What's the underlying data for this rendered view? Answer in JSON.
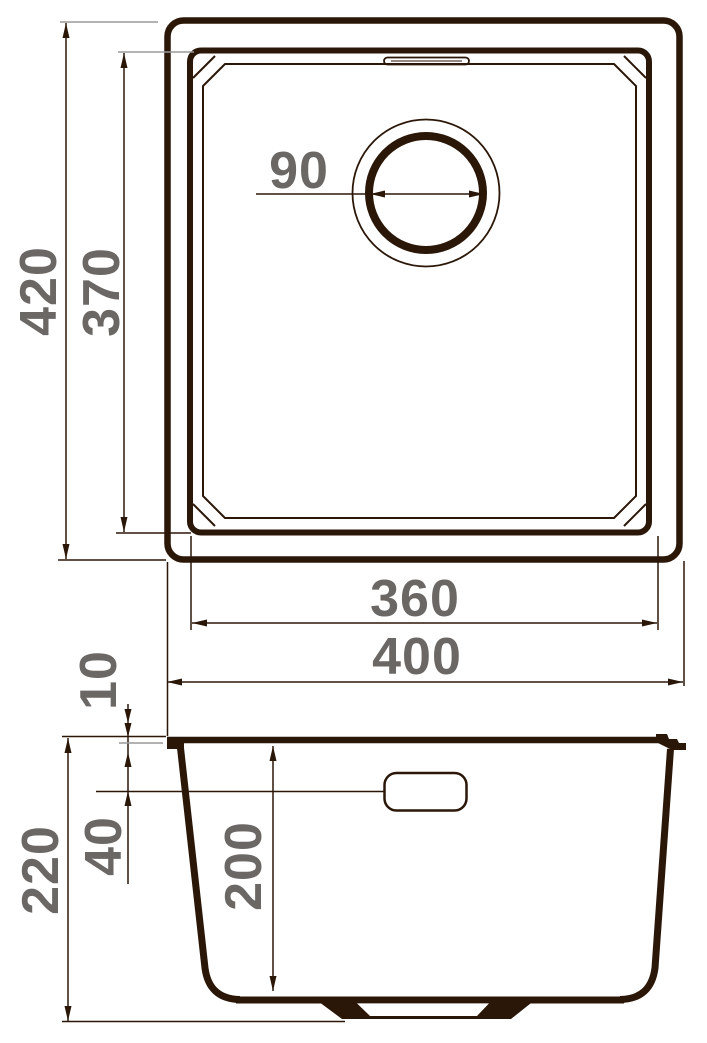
{
  "drawing": {
    "type": "technical-drawing",
    "subject": "square kitchen sink with round drain — top view and cross-section view",
    "units": "mm",
    "colors": {
      "line": "#2b1708",
      "label": "#6b6765",
      "extension_gray": "#9a9a9a",
      "background": "#ffffff"
    },
    "top_view": {
      "overall_height": "420",
      "bowl_height": "370",
      "drain_diameter": "90",
      "bowl_width": "360",
      "overall_width": "400"
    },
    "section_view": {
      "rim_thickness": "10",
      "overflow_offset": "40",
      "overall_depth": "220",
      "bowl_depth": "200"
    }
  }
}
